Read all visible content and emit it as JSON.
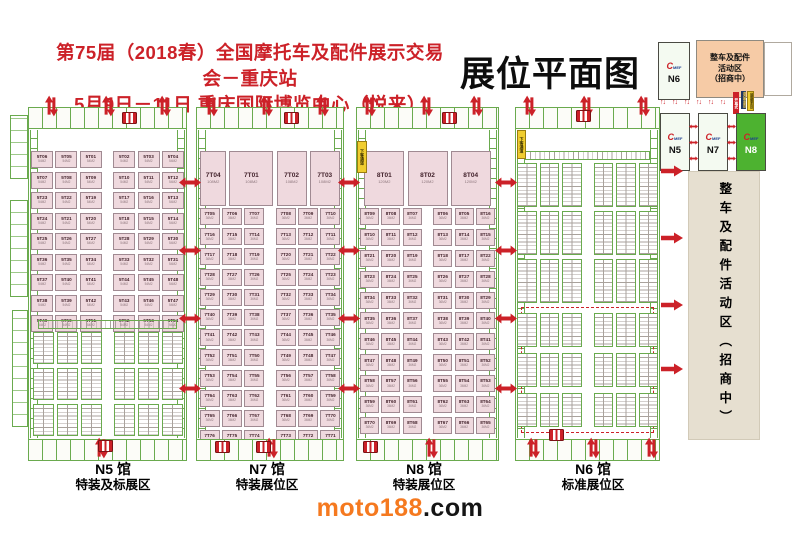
{
  "header": {
    "title_line1": "第75届（2018春）全国摩托车及配件展示交易会－重庆站",
    "title_line2": "5月9日－11日  重庆国际博览中心（悦来）",
    "plan_title": "展位平面图"
  },
  "colors": {
    "accent_red": "#cc2128",
    "booth_pink": "#efd9de",
    "wall_green": "#6aaa4e",
    "n8_highlight_green": "#4db230",
    "activity_salmon": "#f6cba6",
    "panel_beige": "#e6dfd0",
    "brand_orange": "#f5791f"
  },
  "minimap": {
    "logo_c": "C",
    "logo_rest": "MEF",
    "n6_label": "N6",
    "n5_label": "N5",
    "n7_label": "N7",
    "n8_label": "N8",
    "activity_line1": "整车及配件",
    "activity_line2": "活动区",
    "activity_line3": "（招商中）",
    "tags": [
      {
        "label": "开幕式"
      },
      {
        "label": "观众登录处"
      },
      {
        "label": "展商服务处"
      }
    ]
  },
  "side_panel": {
    "text": "整车及配件活动区（招商中）"
  },
  "wall_tag": "下客通道",
  "halls": {
    "n5": {
      "booth_size": "54M2",
      "special_rows": [
        [
          "5T06",
          "5T05",
          "5T01",
          "5T02",
          "5T03",
          "5T04"
        ],
        [
          "5T07",
          "5T08",
          "5T09",
          "5T10",
          "5T11",
          "5T12"
        ],
        [
          "5T23",
          "5T22",
          "5T19",
          "5T17",
          "5T16",
          "5T13"
        ],
        [
          "5T24",
          "5T21",
          "5T20",
          "5T18",
          "5T15",
          "5T14"
        ],
        [
          "5T25",
          "5T26",
          "5T27",
          "5T28",
          "5T29",
          "5T30"
        ],
        [
          "5T36",
          "5T35",
          "5T34",
          "5T33",
          "5T32",
          "5T31"
        ],
        [
          "5T37",
          "5T40",
          "5T41",
          "5T44",
          "5T45",
          "5T48"
        ],
        [
          "5T38",
          "5T39",
          "5T42",
          "5T43",
          "5T46",
          "5T47"
        ],
        [
          "5T49",
          "5T50",
          "5T51",
          "5T52",
          "5T53",
          "5T54"
        ]
      ]
    },
    "n7": {
      "big_row": [
        "7T04",
        "7T01",
        "7T02",
        "7T03"
      ],
      "big_size": "108M2",
      "booth_size": "36M2",
      "rows": [
        [
          "7T05",
          "7T06",
          "7T07",
          "7T08",
          "7T09",
          "7T10"
        ],
        [
          "7T16",
          "7T15",
          "7T14",
          "7T13",
          "7T12",
          "7T11"
        ],
        [
          "7T17",
          "7T18",
          "7T19",
          "7T20",
          "7T21",
          "7T22"
        ],
        [
          "7T28",
          "7T27",
          "7T26",
          "7T25",
          "7T24",
          "7T23"
        ],
        [
          "7T29",
          "7T30",
          "7T31",
          "7T32",
          "7T33",
          "7T34"
        ],
        [
          "7T40",
          "7T39",
          "7T38",
          "7T37",
          "7T36",
          "7T35"
        ],
        [
          "7T41",
          "7T42",
          "7T43",
          "7T44",
          "7T45",
          "7T46"
        ],
        [
          "7T52",
          "7T51",
          "7T50",
          "7T49",
          "7T48",
          "7T47"
        ],
        [
          "7T53",
          "7T54",
          "7T55",
          "7T56",
          "7T57",
          "7T58"
        ],
        [
          "7T64",
          "7T63",
          "7T62",
          "7T61",
          "7T60",
          "7T59"
        ],
        [
          "7T65",
          "7T66",
          "7T67",
          "7T68",
          "7T69",
          "7T70"
        ],
        [
          "7T76",
          "7T75",
          "7T74",
          "7T73",
          "7T72",
          "7T71"
        ]
      ]
    },
    "n8": {
      "big_row": [
        "8T01",
        "8T02",
        "8T04"
      ],
      "big_size": "120M2",
      "booth_size": "36M2",
      "rows": [
        [
          "8T09",
          "8T08",
          "8T07",
          "8T06",
          "8T05",
          "8T16"
        ],
        [
          "8T10",
          "8T11",
          "8T12",
          "8T13",
          "8T14",
          "8T15"
        ],
        [
          "8T21",
          "8T20",
          "8T19",
          "8T18",
          "8T17",
          "8T22"
        ],
        [
          "8T23",
          "8T24",
          "8T25",
          "8T26",
          "8T27",
          "8T28"
        ],
        [
          "8T34",
          "8T33",
          "8T32",
          "8T31",
          "8T30",
          "8T29"
        ],
        [
          "8T35",
          "8T36",
          "8T37",
          "8T38",
          "8T39",
          "8T40"
        ],
        [
          "8T46",
          "8T45",
          "8T44",
          "8T43",
          "8T42",
          "8T41"
        ],
        [
          "8T47",
          "8T48",
          "8T49",
          "8T50",
          "8T51",
          "8T52"
        ],
        [
          "8T58",
          "8T57",
          "8T56",
          "8T55",
          "8T54",
          "8T53"
        ],
        [
          "8T59",
          "8T60",
          "8T61",
          "8T62",
          "8T63",
          "8T64"
        ],
        [
          "8T70",
          "8T69",
          "8T68",
          "8T67",
          "8T66",
          "8T65"
        ]
      ]
    },
    "n6": {
      "top_groups": 3,
      "dashed_groups": 3,
      "stacks_per_group": 6
    }
  },
  "hall_labels": [
    {
      "line1": "N5 馆",
      "line2": "特装及标展区"
    },
    {
      "line1": "N7 馆",
      "line2": "特装展位区"
    },
    {
      "line1": "N8 馆",
      "line2": "特装展位区"
    },
    {
      "line1": "N6 馆",
      "line2": "标准展位区"
    }
  ],
  "footer": {
    "brand_orange": "moto188",
    "brand_black": ".com"
  }
}
